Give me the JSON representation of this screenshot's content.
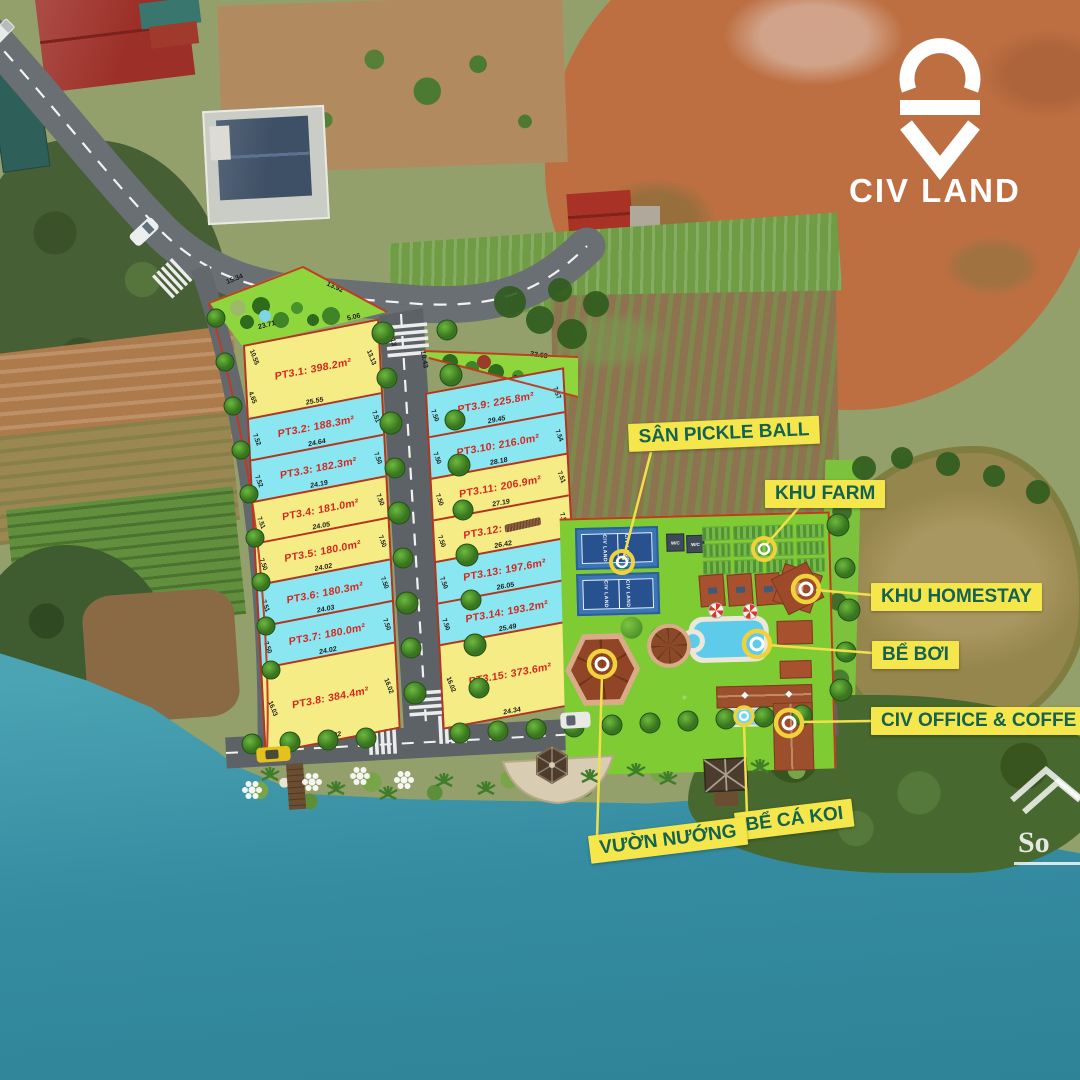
{
  "brand": {
    "logo_text": "CIV LAND"
  },
  "watermark": {
    "text": "So"
  },
  "plots": {
    "left": [
      {
        "name": "PT3.1: 398.2m²",
        "bottom": "25.55",
        "left": "10.55",
        "left2": "4.65",
        "right": "13.13",
        "top2": "5.06"
      },
      {
        "name": "PT3.2: 188.3m²",
        "bottom": "24.64",
        "left": "7.52",
        "right": "7.51"
      },
      {
        "name": "PT3.3: 182.3m²",
        "bottom": "24.19",
        "left": "7.52",
        "right": "7.50"
      },
      {
        "name": "PT3.4: 181.0m²",
        "bottom": "24.05",
        "left": "7.51",
        "right": "7.50"
      },
      {
        "name": "PT3.5: 180.0m²",
        "bottom": "24.02",
        "left": "7.50",
        "right": "7.50"
      },
      {
        "name": "PT3.6: 180.3m²",
        "bottom": "24.03",
        "left": "7.51",
        "right": "7.50"
      },
      {
        "name": "PT3.7: 180.0m²",
        "bottom": "24.02",
        "left": "7.50",
        "right": "7.50"
      },
      {
        "name": "PT3.8: 384.4m²",
        "bottom": "24.02",
        "left": "16.03",
        "right": "16.02"
      }
    ],
    "right": [
      {
        "name": "PT3.9: 225.8m²",
        "bottom": "29.45",
        "left": "7.50",
        "right": "7.57"
      },
      {
        "name": "PT3.10: 216.0m²",
        "bottom": "28.18",
        "left": "7.50",
        "right": "7.54"
      },
      {
        "name": "PT3.11: 206.9m²",
        "bottom": "27.19",
        "left": "7.50",
        "right": "7.51"
      },
      {
        "name": "PT3.12:",
        "bottom": "26.42",
        "left": "7.50",
        "right": "7.52",
        "obscured": true
      },
      {
        "name": "PT3.13: 197.6m²",
        "bottom": "26.05",
        "left": "7.50",
        "right": "7.50"
      },
      {
        "name": "PT3.14: 193.2m²",
        "bottom": "25.49",
        "left": "7.50",
        "right": "7.50"
      },
      {
        "name": "PT3.15: 373.6m²",
        "bottom": "24.34",
        "left": "16.02",
        "right": "15.02"
      }
    ]
  },
  "parks": {
    "top_left": {
      "d1": "15.34",
      "d2": "13.92",
      "d3": "23.71",
      "d4": "5.06",
      "d5": "13.13"
    },
    "top_right": {
      "d1": "32.68",
      "d2": "30.72",
      "d3": "10.43"
    }
  },
  "callouts": {
    "pickleball": "SÂN PICKLE BALL",
    "farm": "KHU FARM",
    "homestay": "KHU HOMESTAY",
    "pool": "BỂ BƠI",
    "office": "CIV OFFICE & COFFE",
    "koi": "BỂ CÁ KOI",
    "bbq": "VƯỜN NƯỚNG"
  },
  "amenities": {
    "wc": "W/C",
    "court_brand": "CIV LAND"
  },
  "colors": {
    "plot_yellow": "#f6ec85",
    "plot_cyan": "#8ae7f1",
    "boundary_red": "#b5341f",
    "label_bg": "#f5e74b",
    "label_text": "#136253",
    "plot_text": "#d6261f",
    "lawn_green": "#7fcb33",
    "water_teal": "#3f97a8",
    "dirt_orange": "#bd6f42"
  }
}
